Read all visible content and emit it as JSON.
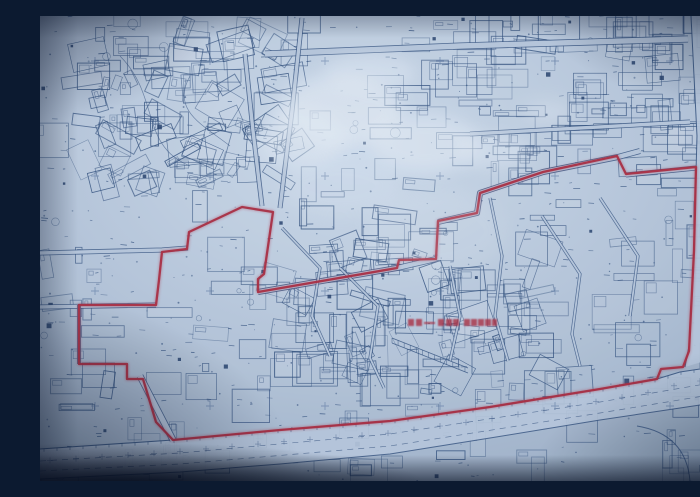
{
  "meta": {
    "description": "Photograph of a blueprint-style cadastral survey map with a red redevelopment boundary outline and an illegible red annotation label; no legible text is rendered in the image",
    "legible_text": false
  },
  "palette": {
    "paper": "#bccbdf",
    "paper_light": "#d3e0ef",
    "paper_dim": "#9db0c7",
    "ink": "#2f4f7d",
    "ink_strong": "#24406b",
    "cross": "#5a76a1",
    "red": "#b12a3e",
    "glare": "#eef4fa",
    "shadow": "#0a1830"
  },
  "boundary": {
    "stroke_width": 2.3,
    "points": [
      [
        202,
        191
      ],
      [
        233,
        196
      ],
      [
        224,
        258
      ],
      [
        218,
        263
      ],
      [
        218,
        276
      ],
      [
        357,
        252
      ],
      [
        359,
        244
      ],
      [
        396,
        243
      ],
      [
        398,
        205
      ],
      [
        437,
        197
      ],
      [
        440,
        177
      ],
      [
        503,
        156
      ],
      [
        577,
        140
      ],
      [
        586,
        158
      ],
      [
        656,
        151
      ],
      [
        654,
        235
      ],
      [
        649,
        335
      ],
      [
        643,
        351
      ],
      [
        621,
        353
      ],
      [
        617,
        363
      ],
      [
        560,
        373
      ],
      [
        450,
        391
      ],
      [
        350,
        405
      ],
      [
        240,
        414
      ],
      [
        133,
        424
      ],
      [
        116,
        406
      ],
      [
        103,
        363
      ],
      [
        87,
        363
      ],
      [
        87,
        348
      ],
      [
        39,
        348
      ],
      [
        39,
        289
      ],
      [
        116,
        289
      ],
      [
        119,
        264
      ],
      [
        122,
        236
      ],
      [
        147,
        233
      ],
      [
        149,
        216
      ]
    ]
  },
  "annotation": {
    "y": 303,
    "h": 7,
    "blocks": [
      {
        "x": 368,
        "w": 6
      },
      {
        "x": 376,
        "w": 6
      },
      {
        "x": 398,
        "w": 6
      },
      {
        "x": 406,
        "w": 6
      },
      {
        "x": 413,
        "w": 6
      },
      {
        "x": 424,
        "w": 6
      },
      {
        "x": 431,
        "w": 6
      },
      {
        "x": 438,
        "w": 6
      },
      {
        "x": 445,
        "w": 6
      },
      {
        "x": 452,
        "w": 5
      }
    ],
    "dash": {
      "x": 384,
      "w": 11
    }
  },
  "boulevard": {
    "curb_top": [
      [
        0,
        433
      ],
      [
        133,
        424
      ],
      [
        240,
        414
      ],
      [
        350,
        405
      ],
      [
        450,
        391
      ],
      [
        560,
        373
      ],
      [
        617,
        363
      ],
      [
        640,
        356
      ],
      [
        700,
        347
      ]
    ],
    "curb_bottom": [
      [
        0,
        463
      ],
      [
        140,
        456
      ],
      [
        240,
        448
      ],
      [
        350,
        438
      ],
      [
        450,
        422
      ],
      [
        560,
        404
      ],
      [
        640,
        392
      ],
      [
        700,
        383
      ]
    ],
    "lane1": [
      [
        0,
        445
      ],
      [
        140,
        437
      ],
      [
        350,
        418
      ],
      [
        560,
        386
      ],
      [
        700,
        362
      ]
    ],
    "lane2": [
      [
        0,
        455
      ],
      [
        140,
        448
      ],
      [
        350,
        430
      ],
      [
        560,
        397
      ],
      [
        700,
        374
      ]
    ]
  },
  "right_road": {
    "curb_west": [
      [
        651,
        0
      ],
      [
        657,
        120
      ],
      [
        654,
        230
      ],
      [
        649,
        330
      ],
      [
        645,
        351
      ]
    ],
    "curb_east": [
      [
        681,
        0
      ],
      [
        687,
        120
      ],
      [
        690,
        230
      ],
      [
        688,
        338
      ]
    ],
    "median": [
      [
        666,
        0
      ],
      [
        671,
        120
      ],
      [
        671,
        230
      ],
      [
        668,
        335
      ]
    ],
    "corner_paths": [
      "M597,410 Q646,418 650,465",
      "M690,388 Q694,420 687,465",
      "M670,400 L664,465"
    ],
    "corner_block": {
      "x": 668,
      "y": 334,
      "w": 30,
      "h": 26,
      "rx": 5
    }
  },
  "streets": [
    {
      "pts": [
        [
          225,
          38
        ],
        [
          420,
          30
        ],
        [
          648,
          23
        ]
      ],
      "g": 7
    },
    {
      "pts": [
        [
          205,
          38
        ],
        [
          213,
          115
        ],
        [
          222,
          190
        ]
      ],
      "g": 5
    },
    {
      "pts": [
        [
          262,
          2
        ],
        [
          252,
          95
        ],
        [
          240,
          192
        ]
      ],
      "g": 5
    },
    {
      "pts": [
        [
          0,
          237
        ],
        [
          122,
          234
        ],
        [
          148,
          232
        ]
      ],
      "g": 5
    },
    {
      "pts": [
        [
          0,
          291
        ],
        [
          116,
          289
        ]
      ],
      "g": 5
    },
    {
      "pts": [
        [
          39,
          289
        ],
        [
          39,
          348
        ]
      ],
      "g": 4
    },
    {
      "pts": [
        [
          100,
          360
        ],
        [
          133,
          424
        ]
      ],
      "g": 7
    },
    {
      "pts": [
        [
          218,
          276
        ],
        [
          357,
          252
        ],
        [
          396,
          243
        ]
      ],
      "g": 6
    },
    {
      "pts": [
        [
          398,
          206
        ],
        [
          437,
          197
        ],
        [
          440,
          177
        ],
        [
          503,
          156
        ],
        [
          578,
          141
        ],
        [
          600,
          135
        ]
      ],
      "g": 6
    },
    {
      "pts": [
        [
          586,
          159
        ],
        [
          656,
          152
        ]
      ],
      "g": 5
    },
    {
      "pts": [
        [
          430,
          118
        ],
        [
          650,
          106
        ]
      ],
      "g": 5
    }
  ],
  "lanes": [
    [
      [
        450,
        182
      ],
      [
        462,
        240
      ],
      [
        455,
        300
      ],
      [
        468,
        345
      ]
    ],
    [
      [
        300,
        252
      ],
      [
        338,
        290
      ],
      [
        330,
        342
      ],
      [
        344,
        372
      ]
    ],
    [
      [
        502,
        200
      ],
      [
        540,
        258
      ],
      [
        532,
        318
      ],
      [
        540,
        350
      ]
    ],
    [
      [
        242,
        212
      ],
      [
        280,
        252
      ],
      [
        272,
        300
      ],
      [
        290,
        340
      ]
    ],
    [
      [
        560,
        182
      ],
      [
        598,
        240
      ],
      [
        590,
        300
      ]
    ],
    [
      [
        410,
        250
      ],
      [
        420,
        300
      ],
      [
        410,
        345
      ]
    ]
  ],
  "hatch_strip": {
    "a": [
      352,
      322
    ],
    "b": [
      428,
      352
    ],
    "gap": 5
  },
  "park_paths": [
    "M80,40 C120,80 100,130 150,150",
    "M150,60 C130,95 165,110 190,130"
  ],
  "grid": {
    "size": 8,
    "positions": [
      [
        55,
        45
      ],
      [
        170,
        45
      ],
      [
        285,
        45
      ],
      [
        400,
        45
      ],
      [
        515,
        45
      ],
      [
        630,
        45
      ],
      [
        690,
        47
      ],
      [
        55,
        160
      ],
      [
        170,
        160
      ],
      [
        285,
        160
      ],
      [
        400,
        160
      ],
      [
        515,
        160
      ],
      [
        55,
        275
      ],
      [
        170,
        275
      ],
      [
        285,
        275
      ],
      [
        400,
        275
      ],
      [
        515,
        275
      ],
      [
        690,
        275
      ],
      [
        55,
        390
      ],
      [
        170,
        390
      ],
      [
        285,
        390
      ],
      [
        400,
        390
      ],
      [
        515,
        390
      ],
      [
        630,
        390
      ]
    ]
  },
  "glare": {
    "blobs": [
      {
        "cx": 300,
        "cy": 95,
        "rx": 62,
        "ry": 36,
        "o": 0.55
      },
      {
        "cx": 385,
        "cy": 128,
        "rx": 55,
        "ry": 28,
        "o": 0.5
      },
      {
        "cx": 262,
        "cy": 122,
        "rx": 42,
        "ry": 30,
        "o": 0.45
      },
      {
        "cx": 330,
        "cy": 57,
        "rx": 46,
        "ry": 18,
        "o": 0.4
      },
      {
        "cx": 455,
        "cy": 135,
        "rx": 36,
        "ry": 18,
        "o": 0.35
      },
      {
        "cx": 508,
        "cy": 96,
        "rx": 26,
        "ry": 13,
        "o": 0.3
      },
      {
        "cx": 395,
        "cy": 215,
        "rx": 70,
        "ry": 42,
        "o": 0.14
      },
      {
        "cx": 300,
        "cy": 170,
        "rx": 60,
        "ry": 30,
        "o": 0.15
      }
    ]
  },
  "texture": {
    "seed": 20240917,
    "zones": [
      {
        "x": 0,
        "y": 0,
        "w": 700,
        "h": 465,
        "n": 210,
        "rot": "axis"
      },
      {
        "x": 40,
        "y": 10,
        "w": 220,
        "h": 160,
        "n": 70,
        "rot": "diag"
      },
      {
        "x": 230,
        "y": 230,
        "w": 280,
        "h": 150,
        "n": 80,
        "rot": "mixed"
      },
      {
        "x": 430,
        "y": 0,
        "w": 270,
        "h": 140,
        "n": 60,
        "rot": "axis"
      }
    ],
    "marks": 420,
    "dots": 260,
    "solids": 40,
    "circles": 25
  }
}
